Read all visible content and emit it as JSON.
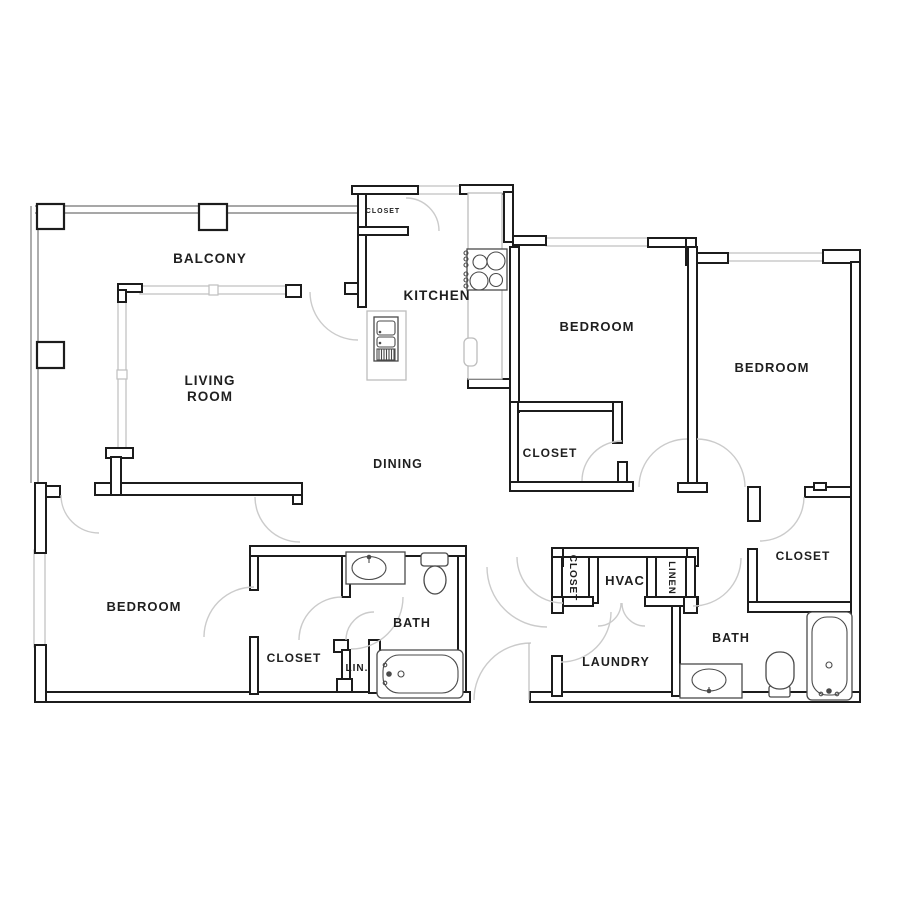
{
  "plan": {
    "type": "apartment-floor-plan",
    "background": "#ffffff",
    "colors": {
      "wall": "#1c1c1c",
      "window": "#bfbfbf",
      "door_arc": "#cbcbcb",
      "fixture": "#4a4a4a",
      "counter": "#bdbdbd",
      "label": "#1f1f1f"
    },
    "rooms": {
      "balcony": {
        "label": "BALCONY"
      },
      "living_room": {
        "label_line1": "LIVING",
        "label_line2": "ROOM"
      },
      "kitchen": {
        "label": "KITCHEN"
      },
      "dining": {
        "label": "DINING"
      },
      "closet_entry": {
        "label": "CLOSET"
      },
      "bedroom_top": {
        "label": "BEDROOM"
      },
      "bedroom_right": {
        "label": "BEDROOM"
      },
      "bedroom_left": {
        "label": "BEDROOM"
      },
      "closet_mid": {
        "label": "CLOSET"
      },
      "closet_right": {
        "label": "CLOSET"
      },
      "closet_bedroom_left": {
        "label": "CLOSET"
      },
      "closet_hall": {
        "label": "CLOSET"
      },
      "linen": {
        "label": "LINEN"
      },
      "lin": {
        "label": "LIN."
      },
      "hvac": {
        "label": "HVAC"
      },
      "laundry": {
        "label": "LAUNDRY"
      },
      "bath_left": {
        "label": "BATH"
      },
      "bath_right": {
        "label": "BATH"
      }
    }
  }
}
